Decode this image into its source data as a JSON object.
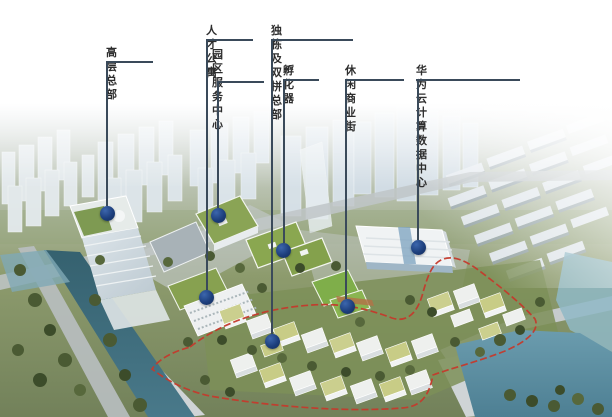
{
  "callouts": [
    {
      "id": "high-rise-hq",
      "label": "高层总部"
    },
    {
      "id": "talent-apartments",
      "label": "人才公寓"
    },
    {
      "id": "park-service-center",
      "label": "园区\n服务中心"
    },
    {
      "id": "detached-duplex-hq",
      "label": "独栋及双拼总部"
    },
    {
      "id": "incubator",
      "label": "孵化器"
    },
    {
      "id": "leisure-commercial-street",
      "label": "休闲商业街"
    },
    {
      "id": "huawei-cloud-data-center",
      "label": "华为云计算数据中心"
    }
  ],
  "colors": {
    "marker_blue": "#1d3f7d",
    "leader_line": "#3a4a5a",
    "label_text": "#2d2d2d",
    "site_boundary_red": "#c43a2c",
    "campus_roof_green": "#8aa455",
    "water_teal": "#4a7c8e"
  }
}
